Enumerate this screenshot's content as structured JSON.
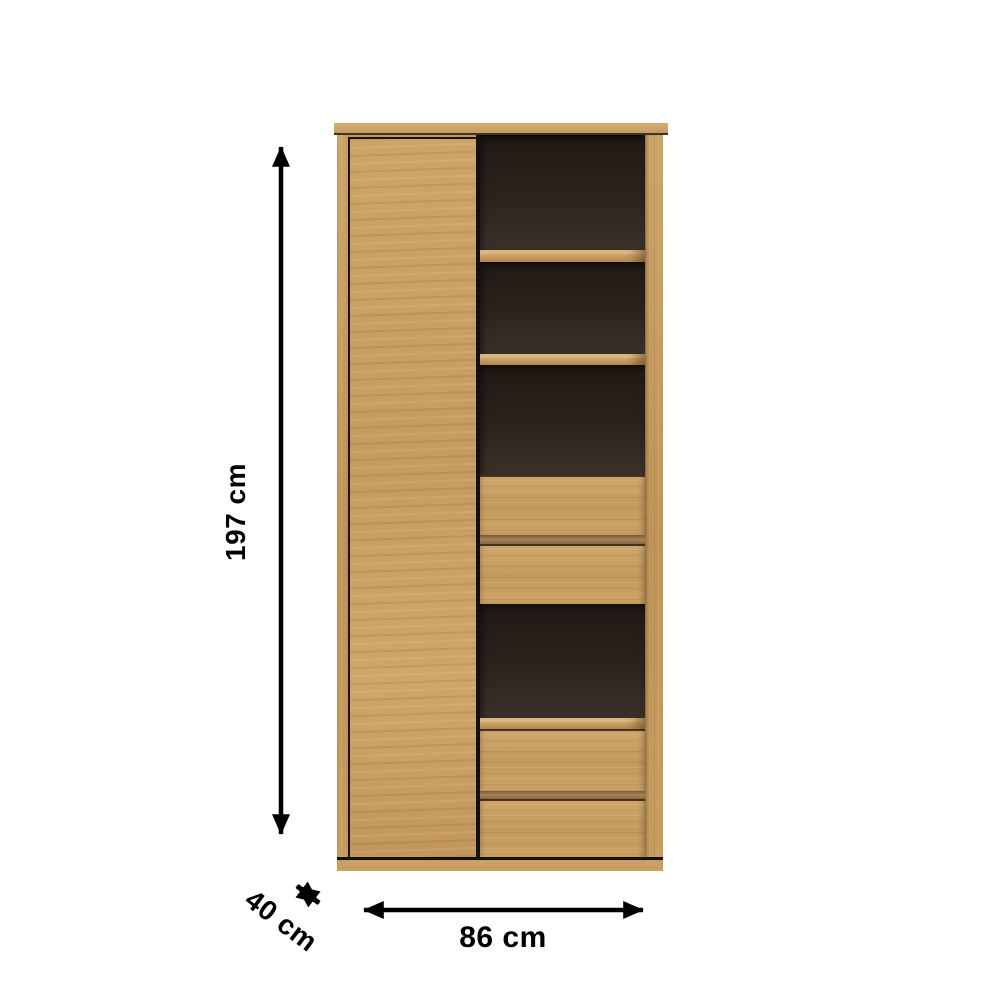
{
  "dimensions": {
    "height_label": "197 cm",
    "width_label": "86 cm",
    "depth_label": "40 cm"
  },
  "colors": {
    "background": "#ffffff",
    "wood": "#c89e63",
    "wood_light": "#d7b078",
    "wood_dark": "#a97f4b",
    "interior_dark": "#2b241e",
    "outline": "#19120a",
    "dimension_line": "#000000"
  },
  "furniture": {
    "type": "tall-cabinet",
    "parts": [
      "top-panel",
      "left-door",
      "open-shelf-1",
      "shelf-board-1",
      "open-shelf-2",
      "shelf-board-2",
      "open-shelf-3",
      "drawer-1",
      "drawer-2",
      "open-shelf-4",
      "drawer-3",
      "drawer-4",
      "base-plinth"
    ]
  }
}
